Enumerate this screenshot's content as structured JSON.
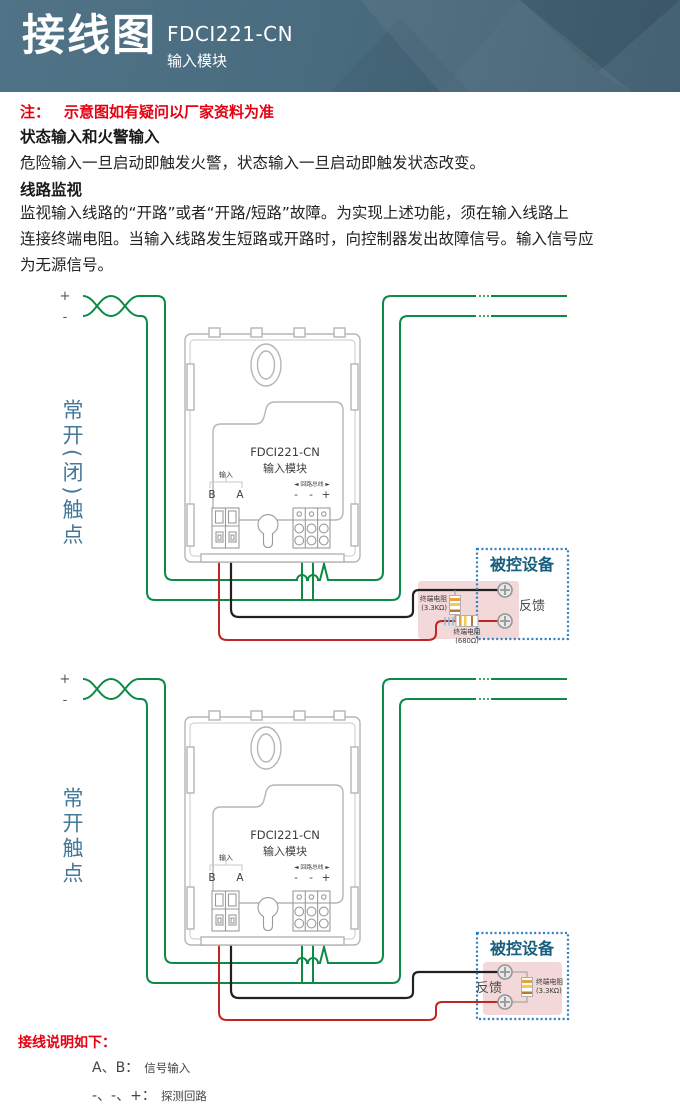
{
  "header": {
    "title": "接线图",
    "model": "FDCI221-CN",
    "subtitle": "输入模块"
  },
  "note": {
    "prefix": "注：",
    "text": "示意图如有疑问以厂家资料为准"
  },
  "sections": {
    "s1_heading": "状态输入和火警输入",
    "s1_body": "危险输入一旦启动即触发火警，状态输入一旦启动即触发状态改变。",
    "s2_heading": "线路监视",
    "s2_line1": "监视输入线路的“开路”或者“开路/短路”故障。为实现上述功能，须在输入线路上",
    "s2_line2": "连接终端电阻。当输入线路发生短路或开路时，向控制器发出故障信号。输入信号应",
    "s2_line3": "为无源信号。"
  },
  "module": {
    "model": "FDCI221-CN",
    "name": "输入模块",
    "input_label": "输入",
    "terminal_b": "B",
    "terminal_a": "A",
    "loop_label": "◄ 回路总线 ►",
    "loop_minus1": "-",
    "loop_minus2": "-",
    "loop_plus": "+"
  },
  "diagram1": {
    "contact_label": "常开(闭)触点",
    "plus": "+",
    "minus": "-",
    "device_title": "被控设备",
    "feedback": "反馈",
    "r1_name": "终端电阻",
    "r1_value": "(3.3KΩ)",
    "r2_name": "终端电阻",
    "r2_value": "(680Ω)"
  },
  "diagram2": {
    "contact_label": "常开触点",
    "plus": "+",
    "minus": "-",
    "device_title": "被控设备",
    "feedback": "反馈",
    "r1_name": "终端电阻",
    "r1_value": "(3.3KΩ)"
  },
  "footer": {
    "title": "接线说明如下：",
    "line1_key": "A、B：",
    "line1_val": "信号输入",
    "line2_key": "-、-、+：",
    "line2_val": "探测回路"
  },
  "colors": {
    "wire_loop": "#0d8a45",
    "wire_signal_b": "#bf2522",
    "wire_signal_a": "#242021",
    "accent_teal": "#44789a",
    "note_red": "#e60012"
  }
}
